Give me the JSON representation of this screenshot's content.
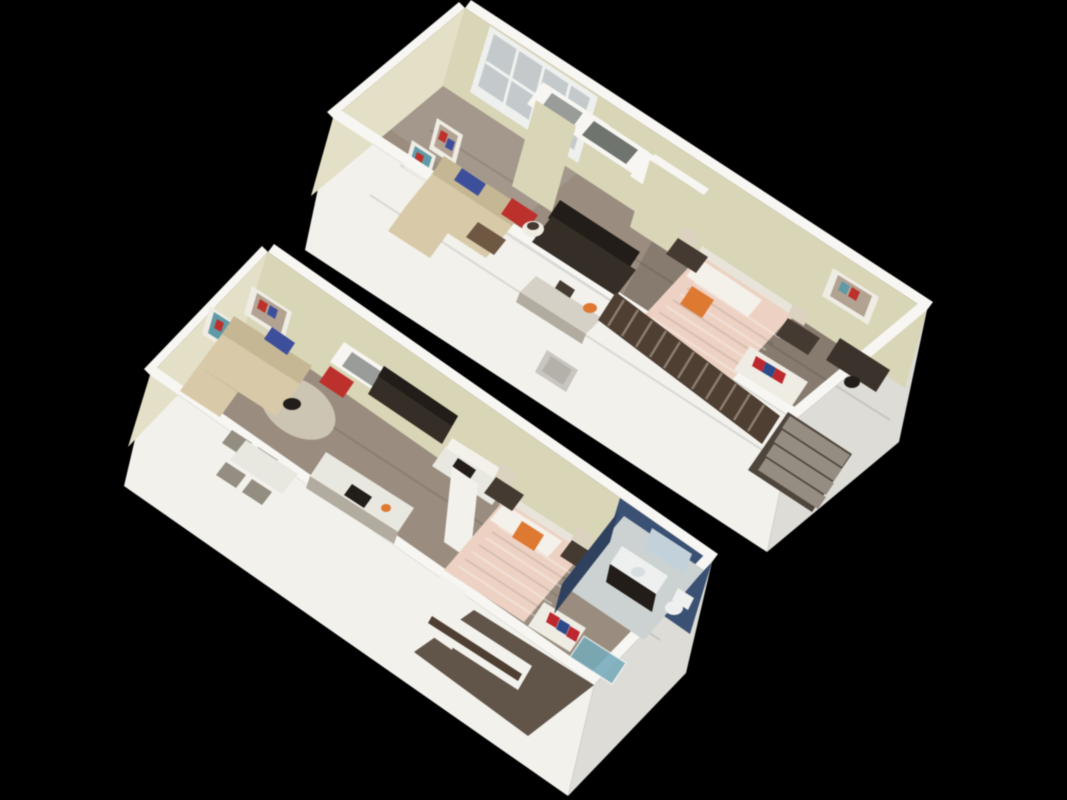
{
  "canvas": {
    "width": 1067,
    "height": 800,
    "background": "#000000"
  },
  "scene": {
    "type": "3d-floor-plan-render",
    "units": [
      {
        "name": "upper-unit",
        "position": "top-right",
        "rooms": [
          "living-room",
          "kitchen",
          "closets",
          "bedroom",
          "stairs"
        ]
      },
      {
        "name": "lower-unit",
        "position": "bottom-left",
        "rooms": [
          "living-room",
          "dining-area",
          "kitchen",
          "bedroom",
          "bathroom",
          "entry-hall"
        ]
      }
    ]
  },
  "colors": {
    "background": "#000000",
    "extWallBright": "#f2f1ec",
    "extWallShade": "#dddcd6",
    "wallCap": "#f7f6f2",
    "wallBeige": "#d9d5b6",
    "wallBeigeLight": "#e4e0c6",
    "windowFrame": "#eef0ee",
    "windowGlass": "#c4cacb",
    "floorWood": "#9a8d7e",
    "floorDark": "#615549",
    "grayInterior": "#999c99",
    "nicheDark": "#70746f",
    "darkCabinet": "#352e27",
    "counterDark": "#221d18",
    "counterLight": "#d5d1c6",
    "counterFace": "#b2ab9e",
    "sofa": "#d9caa7",
    "sofaShade": "#c7b792",
    "pillowBlue": "#3c4f9d",
    "accentRed": "#c2302c",
    "ottoman": "#6f5843",
    "tableWhite": "#e8e8e1",
    "chairGray": "#948e81",
    "rug": "#cdc5b2",
    "bedDuvet": "#eed2c2",
    "pillowWhite": "#f4f1ea",
    "headboard": "#e8e4da",
    "accentOrange": "#e2782e",
    "nightstand": "#443a31",
    "lampShade": "#dbd2bf",
    "railWood": "#4f3f31",
    "shelfWhite": "#efece4",
    "bookRed": "#c1272d",
    "bookBlue": "#2c4a8c",
    "stairTread": "#968d81",
    "stairDark": "#4e463c",
    "bathBlue": "#3a5175",
    "bathBlueDark": "#2e4160",
    "bathFloor": "#ccd2d1",
    "fixtureWhite": "#eef0ef",
    "sinkGray": "#d7dde0",
    "mirror": "#c3d2da",
    "showerTeal": "#74aabb",
    "artInner": "#b3a291",
    "artTeal": "#5e9aa8",
    "ventGray": "#c9c6bf",
    "ventInner": "#b4b1aa",
    "deskDark": "#3a322b"
  }
}
